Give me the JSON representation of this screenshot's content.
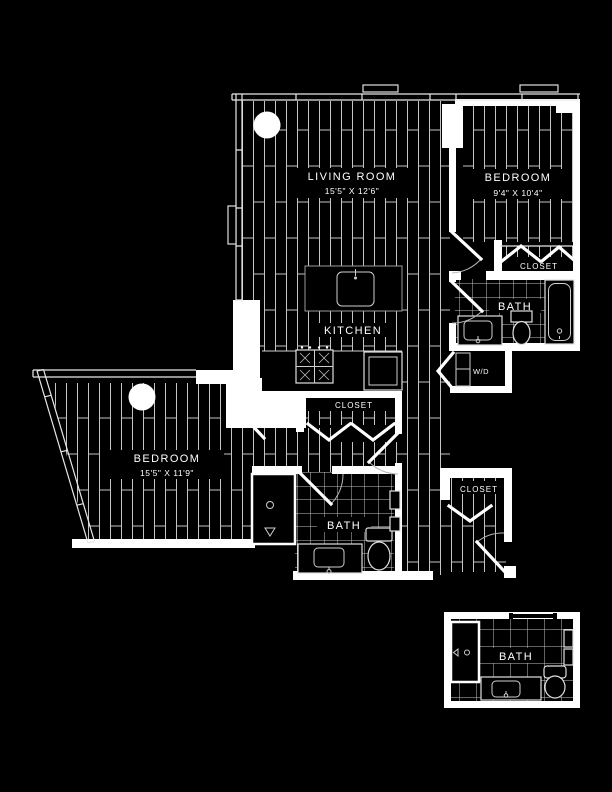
{
  "colors": {
    "background": "#000000",
    "walls": "#ffffff",
    "floor_lines": "#c4c4c4",
    "text": "#ffffff"
  },
  "rooms": {
    "living_room": {
      "label": "LIVING ROOM",
      "dims": "15'5\" X 12'6\""
    },
    "bedroom_right": {
      "label": "BEDROOM",
      "dims": "9'4\" X 10'4\""
    },
    "bedroom_left": {
      "label": "BEDROOM",
      "dims": "15'5\" X 11'9\""
    },
    "kitchen": {
      "label": "KITCHEN"
    },
    "bath_right": {
      "label": "BATH"
    },
    "bath_lower": {
      "label": "BATH"
    },
    "bath_detail": {
      "label": "BATH"
    },
    "closet_bedroom_right": {
      "label": "CLOSET"
    },
    "closet_hall": {
      "label": "CLOSET"
    },
    "closet_entry": {
      "label": "CLOSET"
    },
    "washer_dryer": {
      "label": "W/D"
    }
  }
}
